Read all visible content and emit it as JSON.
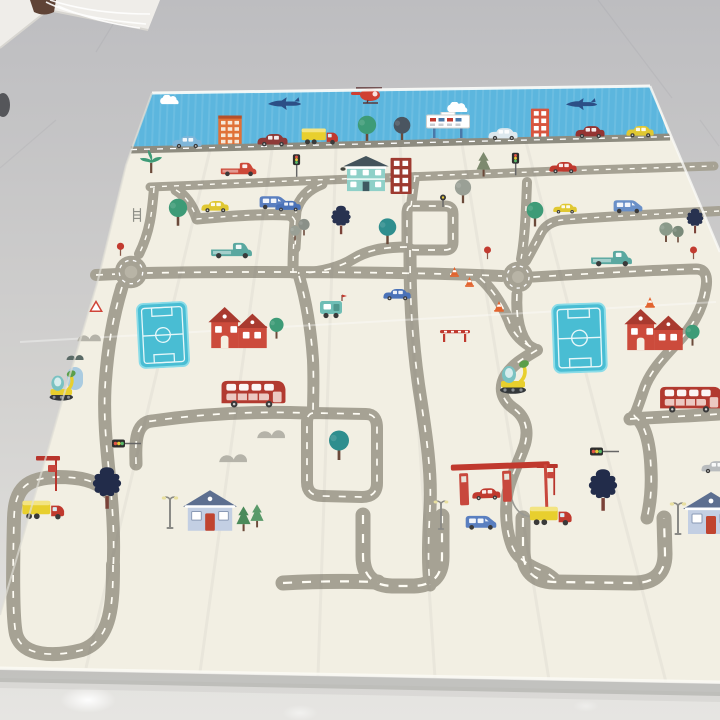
{
  "scene": {
    "type": "photograph",
    "subject": "foldable kids play mat printed with a cartoon city road map for toy cars",
    "setting": "glossy light-gray tiled floor, white wall and clothes-rack wires at top-left corner",
    "camera": "oblique angle; mat recedes toward the top of the frame",
    "mat_sections": [
      "blue sky border strip with clouds, helicopter, fighter jets, towers, billboard and a row of cars on a dark base road",
      "cream play field with looping gray roads, white dashed centerlines, two roundabouts, two teal sports fields, houses, vehicles, trees and a gas station"
    ]
  },
  "palette": {
    "floorTop": "#bdbdc0",
    "floorMid": "#d3d2d0",
    "floorBottom": "#e6e5e2",
    "wallWhite": "#efede9",
    "matCream": "#f2efe3",
    "skyBlue": "#5cb6de",
    "roadGray": "#a6a294",
    "roadDark": "#8e8c80",
    "dashWhite": "#fffdf5",
    "fieldTeal": "#49bdd3",
    "fieldTrim": "#8adce8",
    "busRed": "#b23a30",
    "brickRed": "#c0392e",
    "houseRed": "#cc4b3c",
    "roofRed": "#a93a2f",
    "tealHouse": "#8fd0c8",
    "blueHouseRoof": "#5d6f90",
    "blueHouseWall": "#c3cfe3",
    "treeGreen": "#3e9b77",
    "treeTeal": "#2f8e8e",
    "treeGray": "#9aa096",
    "treeDark": "#283250",
    "pineGray": "#7d8a6e",
    "truckYellow": "#e8cf2e",
    "carBlue": "#4a72b8",
    "vanBlue": "#5a7fc0",
    "lightBlueCar": "#7fb6d9",
    "jetNavy": "#2c4f86",
    "heliRed": "#cf3f32",
    "tealTruck": "#5aa8a0",
    "carYellow": "#e0c832",
    "darkRedCar": "#8e3a38",
    "orange": "#e07238",
    "coneOrange": "#e2642f",
    "bumpsGray": "#b5b3a9",
    "trunkBrown": "#6b4a3a"
  },
  "objects": [
    "cloud",
    "cloud",
    "red-helicopter",
    "fighter-jet",
    "fighter-jet",
    "orange-tower",
    "red-tower",
    "billboard-sign",
    "skyline-blue-car",
    "skyline-dark-red-car",
    "skyline-box-truck",
    "skyline-white-car",
    "skyline-red-car",
    "skyline-yellow-car",
    "skyline-green-tree",
    "skyline-dark-tree",
    "red-pickup-truck",
    "traffic-light",
    "two-story-teal-house",
    "brick-window-tower",
    "gray-pine-tree",
    "red-sedan",
    "roundabout",
    "roundabout",
    "soccer-field",
    "soccer-field",
    "red-gabled-house",
    "red-gabled-house",
    "double-decker-bus",
    "double-decker-bus",
    "ice-cream-cart",
    "blue-sedan",
    "blue-sedan",
    "yellow-sedan",
    "blue-van",
    "blue-van",
    "blue-van",
    "teal-flatbed-truck",
    "teal-flatbed-truck",
    "excavator",
    "excavator",
    "gas-station",
    "fuel-pump",
    "fuel-pump",
    "red-car-at-pump",
    "tanker-truck",
    "box-truck",
    "street-lamp",
    "street-lamp",
    "street-lamp",
    "bus-stop-sign",
    "bus-stop-sign",
    "traffic-cone",
    "traffic-cone",
    "traffic-cone",
    "traffic-cone",
    "warning-triangle-sign",
    "lollipop-sign",
    "lollipop-sign",
    "lollipop-sign",
    "road-barrier",
    "rock-bushes",
    "rock-bushes",
    "rock-bushes",
    "blue-house",
    "blue-house",
    "pine-trees",
    "dark-blob-tree",
    "dark-blob-tree",
    "palm-tree",
    "green-trees",
    "teal-trees",
    "ladder-rack",
    "signal-ball",
    "gray-parked-car"
  ],
  "floor_details": [
    "white-wall-corner",
    "brown-object",
    "white-rack-wires",
    "tile-seams",
    "light-reflections",
    "mat-edge-shadow"
  ]
}
